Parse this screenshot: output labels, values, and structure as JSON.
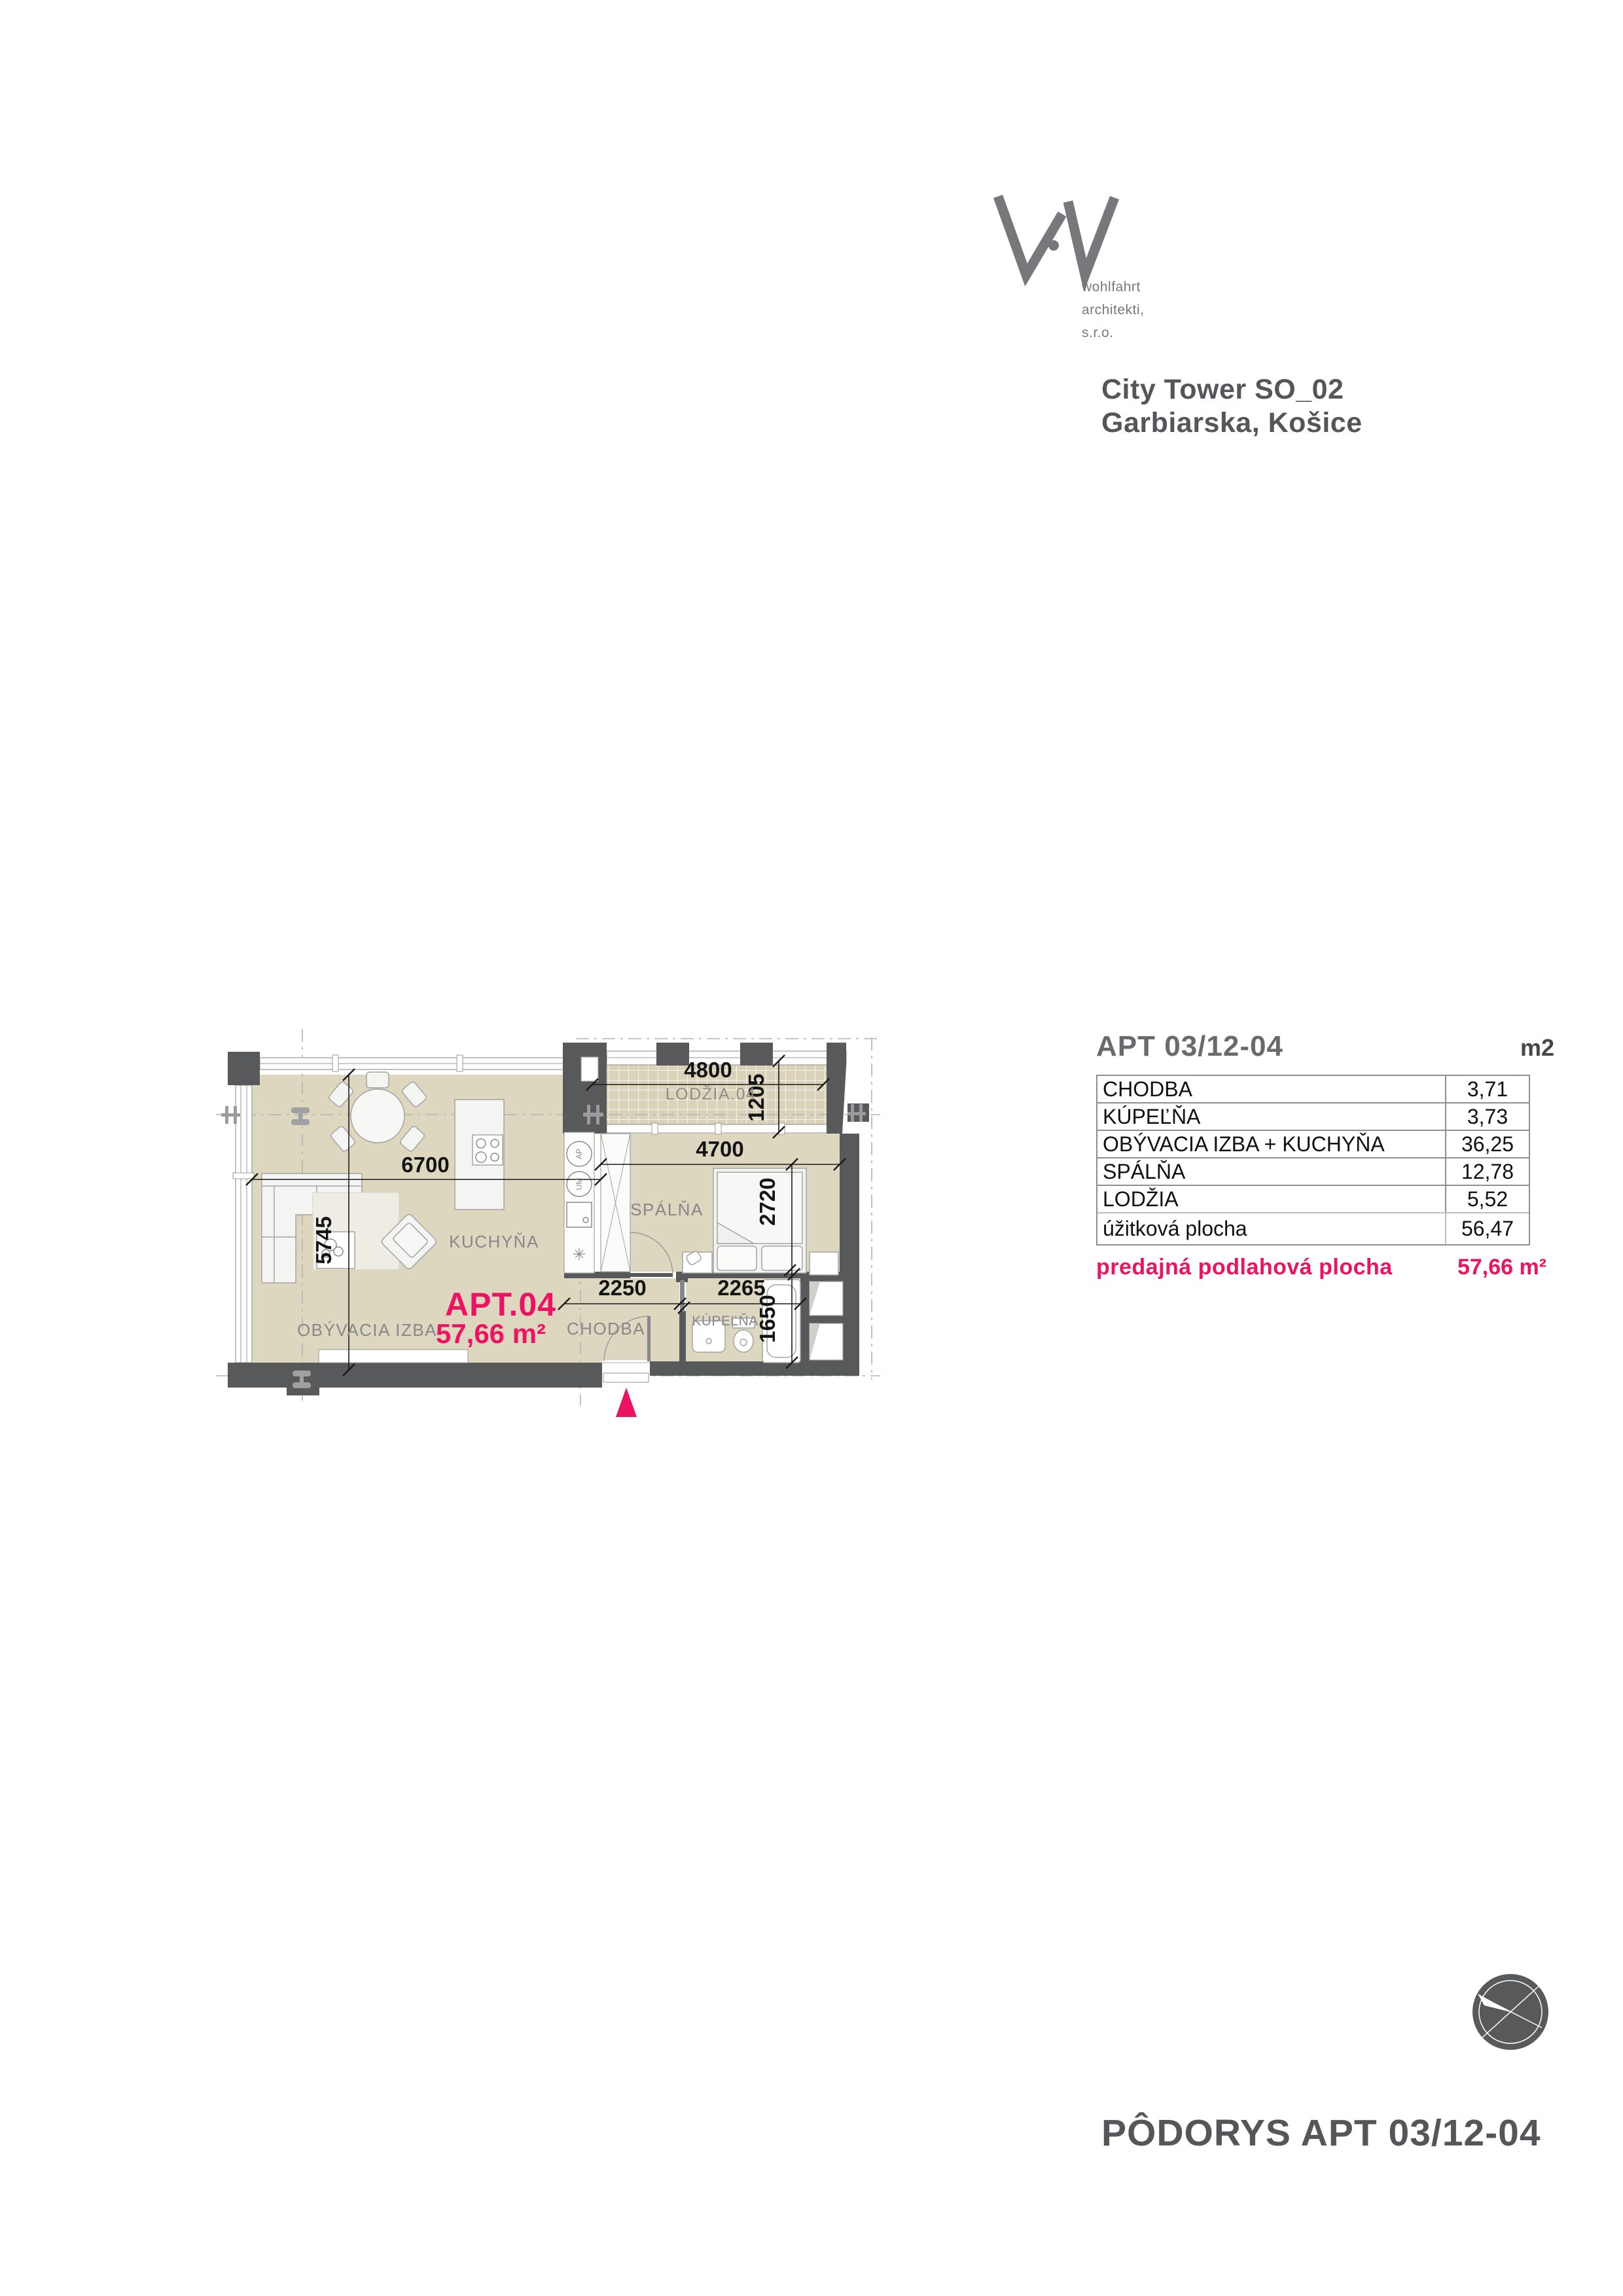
{
  "brand": {
    "logo_lines": [
      "wohlfahrt",
      "architekti,",
      "s.r.o."
    ]
  },
  "project": {
    "name": "City Tower SO_02",
    "address": "Garbiarska, Košice"
  },
  "area_table": {
    "title": "APT 03/12-04",
    "unit_label": "m2",
    "rows": [
      {
        "label": "CHODBA",
        "value": "3,71"
      },
      {
        "label": "KÚPEĽŇA",
        "value": "3,73"
      },
      {
        "label": "OBÝVACIA IZBA + KUCHYŇA",
        "value": "36,25"
      },
      {
        "label": "SPÁLŇA",
        "value": "12,78"
      },
      {
        "label": "LODŽIA",
        "value": "5,52"
      }
    ],
    "subtotal": {
      "label": "úžitková plocha",
      "value": "56,47"
    },
    "total": {
      "label": "predajná podlahová plocha",
      "value": "57,66 m²"
    }
  },
  "floor_plan": {
    "apartment_label": "APT.04",
    "apartment_area": "57,66 m²",
    "rooms": {
      "living": "OBÝVACIA IZBA",
      "kitchen": "KUCHYŇA",
      "bedroom": "SPÁLŇA",
      "hall": "CHODBA",
      "bathroom": "KÚPEĽŇA",
      "loggia": "LODŽIA.04"
    },
    "dimensions": {
      "living_width": "6700",
      "living_depth": "5745",
      "loggia_width": "4800",
      "loggia_depth": "1205",
      "bedroom_width": "4700",
      "bedroom_depth": "2720",
      "hall_width": "2250",
      "bathroom_width": "2265",
      "bathroom_depth": "1650"
    },
    "appliances": {
      "ap": "AP",
      "um": "UM"
    }
  },
  "footer": {
    "drawing_title": "PÔDORYS APT 03/12-04"
  },
  "colors": {
    "accent": "#ee1262",
    "wall": "#58595b",
    "floor": "#ded7c0",
    "label": "#87878b"
  }
}
